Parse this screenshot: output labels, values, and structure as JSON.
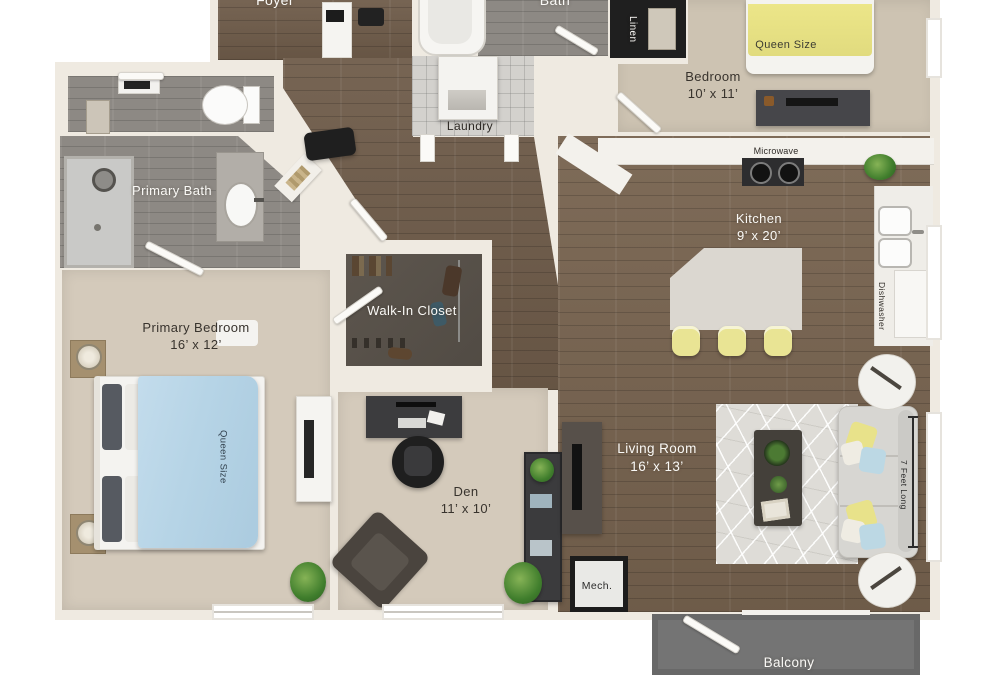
{
  "rooms": {
    "foyer": {
      "name": "Foyer"
    },
    "bath": {
      "name": "Bath"
    },
    "linen": {
      "name": "Linen"
    },
    "bedroom": {
      "name": "Bedroom",
      "dims": "10’ x 11’"
    },
    "laundry": {
      "name": "Laundry"
    },
    "primary_bath": {
      "name": "Primary Bath"
    },
    "kitchen": {
      "name": "Kitchen",
      "dims": "9’ x 20’"
    },
    "walk_in_closet": {
      "name": "Walk-In Closet"
    },
    "primary_bedroom": {
      "name": "Primary Bedroom",
      "dims": "16’ x 12’"
    },
    "den": {
      "name": "Den",
      "dims": "11’ x 10’"
    },
    "living_room": {
      "name": "Living Room",
      "dims": "16’ x 13’"
    },
    "mech": {
      "name": "Mech."
    },
    "balcony": {
      "name": "Balcony"
    }
  },
  "annotations": {
    "microwave": "Microwave",
    "dishwasher": "Dishwasher",
    "bedroom_bed_size": "Queen Size",
    "primary_bed_size": "Queen Size",
    "sofa_length": "7 Feet Long"
  },
  "colors": {
    "wood_floor": "#6f5c4a",
    "gray_wood_floor": "#8d8984",
    "carpet": "#d4cabb",
    "wall": "#efeae1",
    "balcony_floor": "#747474",
    "bed_yellow": "#e9e38d",
    "bed_blue": "#b8d6e8"
  }
}
